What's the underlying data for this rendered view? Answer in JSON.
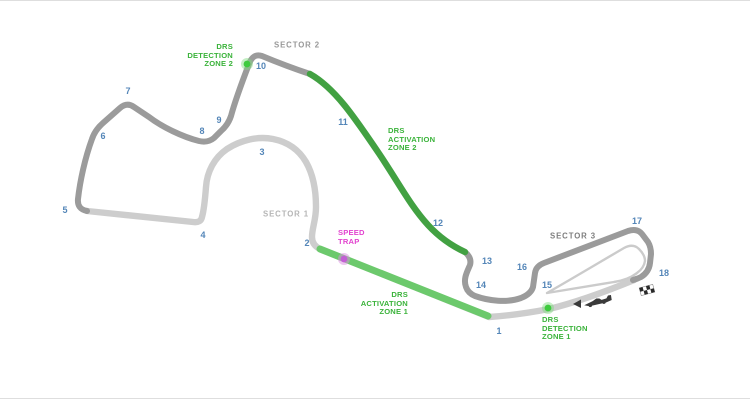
{
  "map": {
    "type": "f1-circuit-map",
    "sectors": {
      "sector1": "SECTOR 1",
      "sector2": "SECTOR 2",
      "sector3": "SECTOR 3"
    },
    "annotations": {
      "drs_detection_zone_2": "DRS\nDETECTION\nZONE 2",
      "drs_activation_zone_2": "DRS\nACTIVATION\nZONE 2",
      "drs_activation_zone_1": "DRS\nACTIVATION\nZONE 1",
      "drs_detection_zone_1": "DRS\nDETECTION\nZONE 1",
      "speed_trap": "SPEED\nTRAP"
    },
    "turns": [
      "1",
      "2",
      "3",
      "4",
      "5",
      "6",
      "7",
      "8",
      "9",
      "10",
      "11",
      "12",
      "13",
      "14",
      "15",
      "16",
      "17",
      "18"
    ],
    "icons": {
      "finish_line": "checkered-flag-icon",
      "travel_direction": "direction-arrow-icon",
      "car": "car-icon",
      "drs_detection_marker": "drs-detection-dot",
      "speed_trap_marker": "speed-trap-dot"
    },
    "colors": {
      "track_sector1_light_gray": "#cdcdcd",
      "track_sector23_dark_gray": "#9b9b9b",
      "pit_lane_gray": "#cbcbcb",
      "drs_zone1_green": "#6cc96c",
      "drs_zone2_green": "#42a142",
      "label_green": "#3bb33b",
      "detection_dot_green": "#3ecb3e",
      "speed_trap_magenta": "#e243cf",
      "speed_trap_dot": "#c25fd4",
      "turn_number_blue": "#5486b8",
      "sector1_label_gray": "#b5b5b5",
      "sector2_label_gray": "#989898",
      "sector3_label_gray": "#7d7d7d"
    }
  }
}
